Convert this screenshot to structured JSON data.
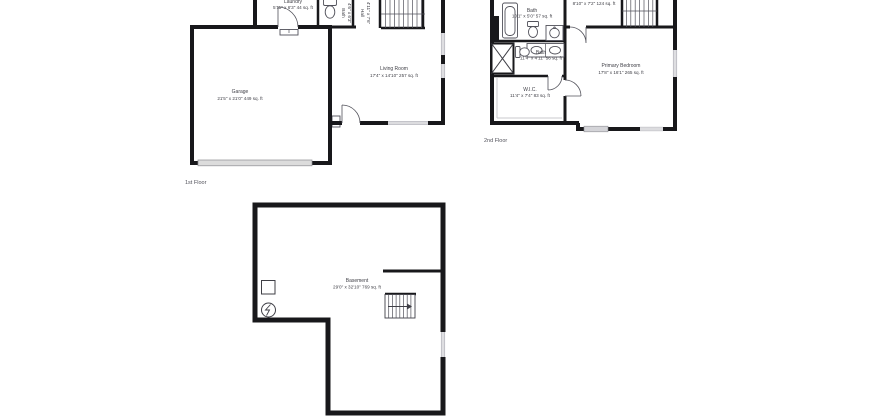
{
  "colors": {
    "background": "#ffffff",
    "wall": "#18181b",
    "text": "#3f3f46",
    "muted_text": "#52525b",
    "garage_door_fill": "#dcdcdc",
    "slider_fill": "#d4d4d8"
  },
  "floors": {
    "first": {
      "floor_label": "1st Floor",
      "garage": {
        "name": "Garage",
        "dims": "21'5\" x 21'0\" 449 sq. ft"
      },
      "living_room": {
        "name": "Living Room",
        "dims": "17'4\" x 14'10\" 257 sq. ft"
      },
      "laundry": {
        "name": "Laundry",
        "dims": "5'11\" x 6'3\" 44 sq. ft"
      },
      "bath": {
        "name": "Bath",
        "dims": "4'6\" x 6'3\""
      },
      "hall": {
        "name": "Hall",
        "dims": "4'11\" x 7'6\""
      }
    },
    "second": {
      "floor_label": "2nd Floor",
      "hall": {
        "dims": "8'10\" x 7'2\" 124 sq. ft"
      },
      "bath_upper": {
        "name": "Bath",
        "dims": "10'1\" x 5'0\" 57 sq. ft"
      },
      "bath_lower": {
        "name": "Bath",
        "dims": "11'4\" x 4'11\" 56 sq. ft"
      },
      "wic": {
        "name": "W.I.C.",
        "dims": "11'4\" x 7'4\" 83 sq. ft"
      },
      "primary_bedroom": {
        "name": "Primary Bedroom",
        "dims": "17'8\" x 16'1\" 265 sq. ft"
      }
    },
    "basement": {
      "room": {
        "name": "Basement",
        "dims": "29'0\" x 32'10\" 769 sq. ft"
      }
    }
  }
}
